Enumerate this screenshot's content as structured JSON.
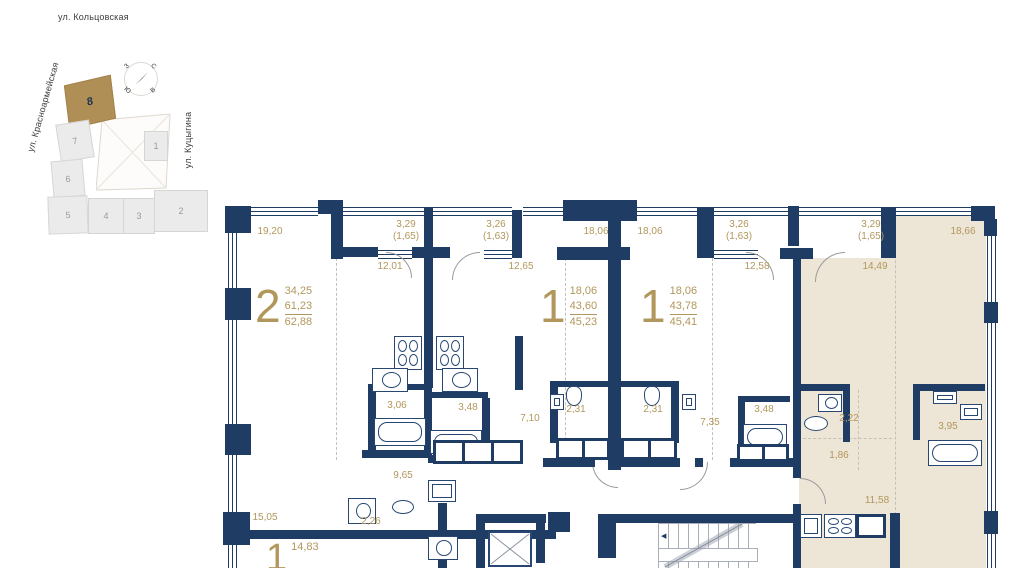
{
  "map": {
    "street_top": "ул. Кольцовская",
    "street_left": "ул. Красноармейская",
    "street_bottom": "ул. Фридриха Энгельса",
    "street_right": "ул. Куцыгина",
    "compass": {
      "north": "С",
      "south": "Ю",
      "west": "З",
      "east": "В"
    },
    "blocks": [
      {
        "label": "8",
        "selected": true
      },
      {
        "label": "7"
      },
      {
        "label": "6"
      },
      {
        "label": "5"
      },
      {
        "label": "4"
      },
      {
        "label": "3"
      },
      {
        "label": "2"
      },
      {
        "label": "1"
      }
    ]
  },
  "plan": {
    "badges": [
      {
        "rooms": "2",
        "values": [
          "34,25",
          "61,23",
          "62,88"
        ]
      },
      {
        "rooms": "1",
        "values": [
          "18,06",
          "43,60",
          "45,23"
        ]
      },
      {
        "rooms": "1",
        "values": [
          "18,06",
          "43,78",
          "45,41"
        ]
      },
      {
        "rooms": "1",
        "values": [
          "14,83"
        ]
      }
    ],
    "labels": [
      "19,20",
      "3,29",
      "(1,65)",
      "12,01",
      "3,26",
      "(1,63)",
      "12,65",
      "18,06",
      "18,06",
      "3,26",
      "(1,63)",
      "12,58",
      "3,29",
      "(1,65)",
      "14,49",
      "18,66",
      "3,06",
      "3,48",
      "7,10",
      "2,31",
      "2,31",
      "7,35",
      "3,48",
      "2,22",
      "3,95",
      "9,65",
      "1,86",
      "15,05",
      "2,26",
      "11,58"
    ]
  },
  "colors": {
    "wall": "#1e3c64",
    "accent": "#b2975c",
    "highlight": "#ede5d6",
    "map_selected": "#b08f56"
  }
}
